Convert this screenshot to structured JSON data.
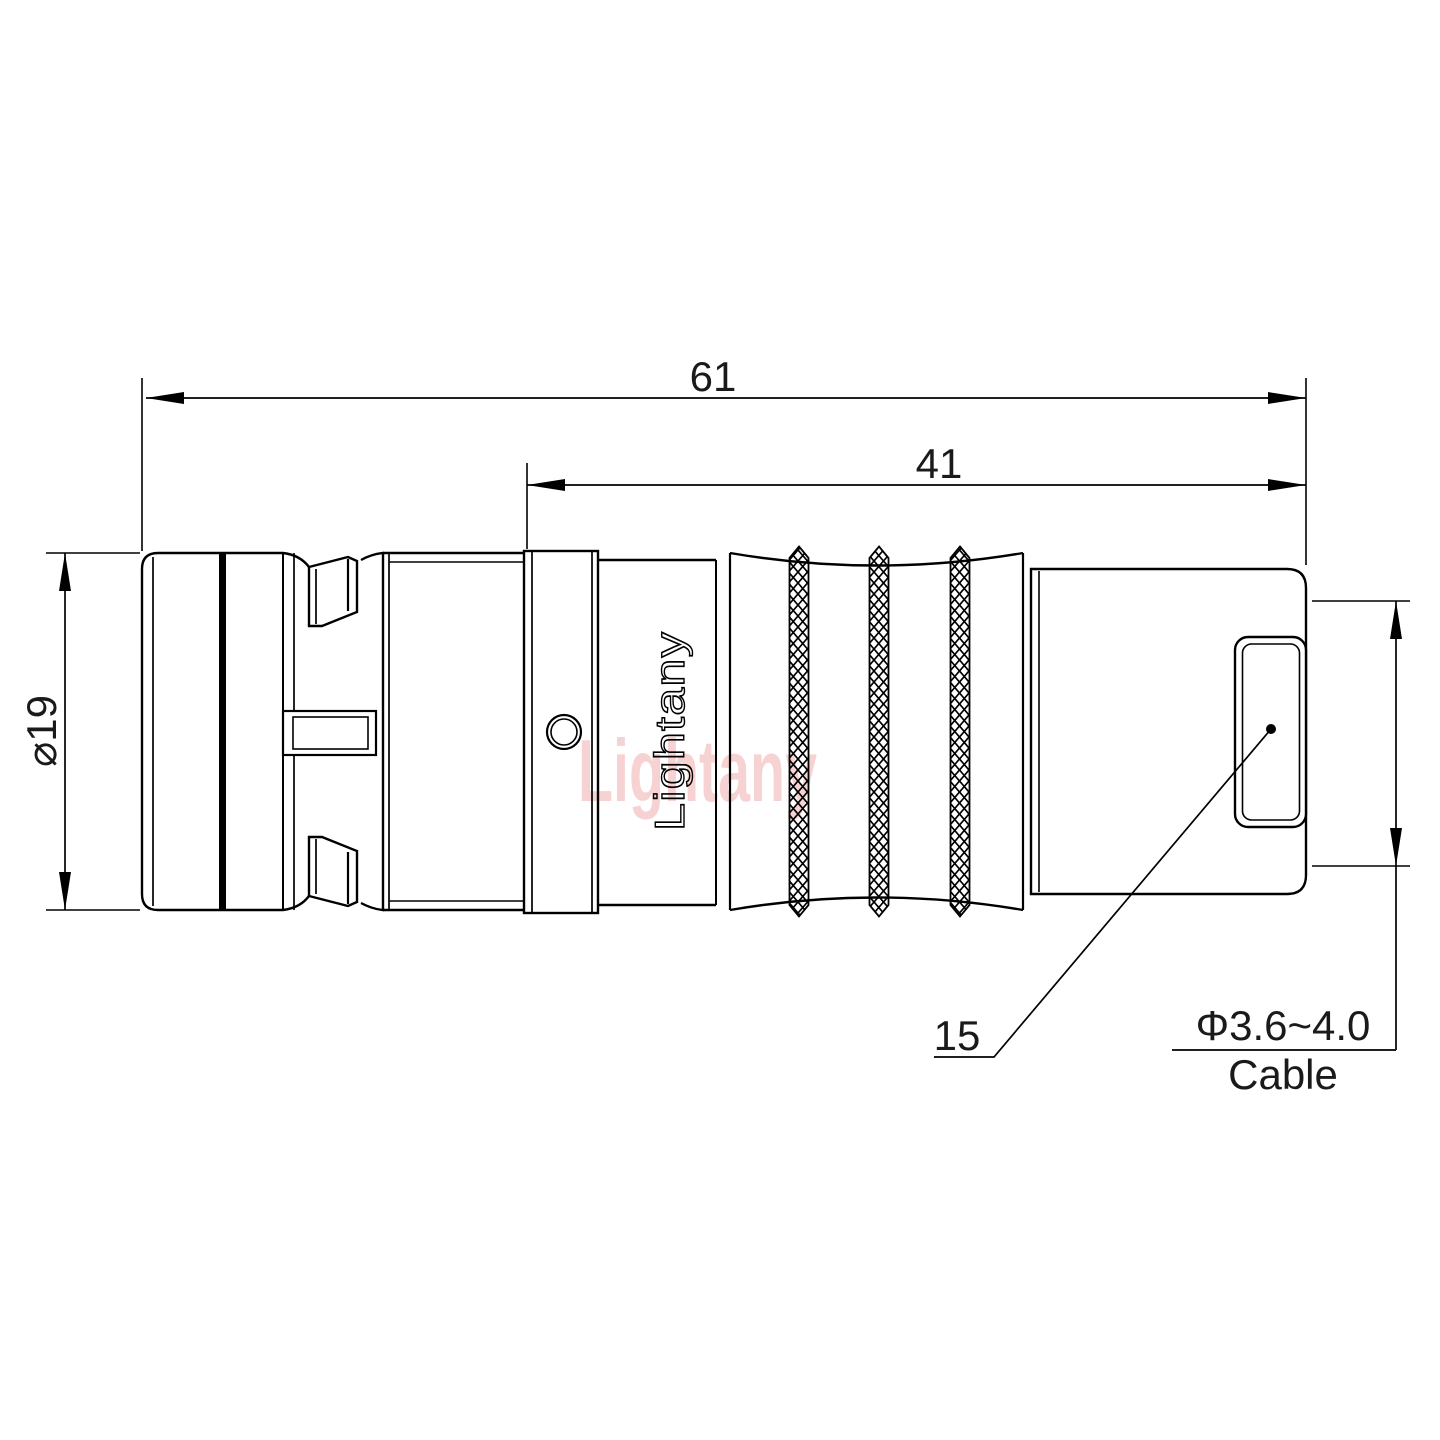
{
  "page": {
    "background": "#ffffff",
    "line_color": "#000000"
  },
  "branding": {
    "body_text": "Lightany",
    "watermark_text": "Lightany",
    "watermark_color": "#dd5c5c"
  },
  "dimensions": {
    "overall_length": "61",
    "rear_section_length": "41",
    "outer_diameter": "⌀19",
    "ref_number": "15",
    "cable_diameter": "Φ3.6~4.0",
    "cable_label": "Cable"
  }
}
